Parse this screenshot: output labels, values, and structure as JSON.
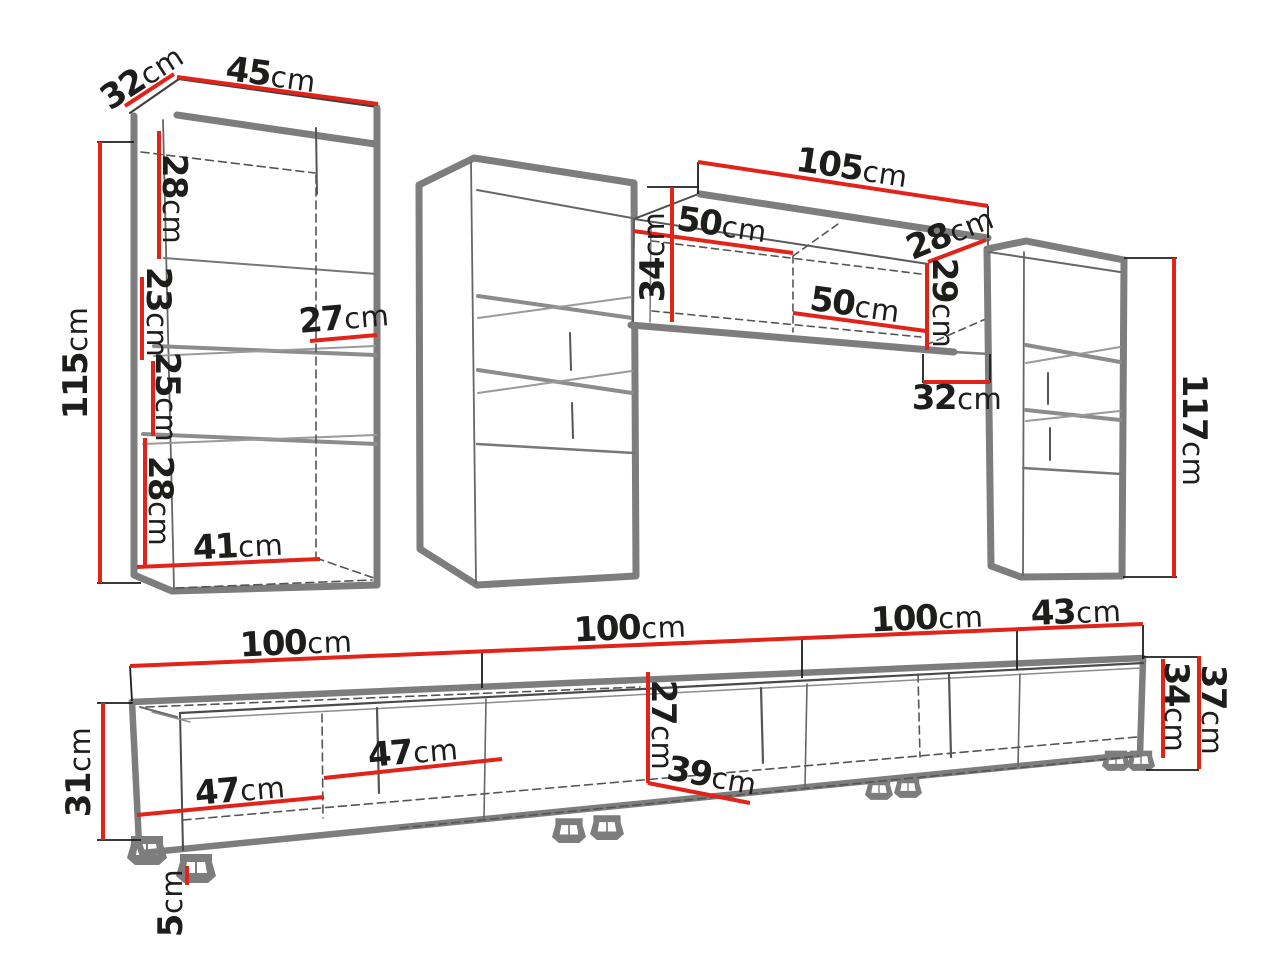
{
  "diagram": {
    "type": "furniture-wall-unit-dimension-diagram",
    "unit": "cm",
    "colors": {
      "dimension_red": "#e2231a",
      "outline_gray": "#7d7d7d",
      "detail_gray": "#4d4d4d",
      "text_black": "#1d1d1b",
      "background": "#ffffff"
    },
    "labels": {
      "left_cab_depth": {
        "num": "32",
        "unit": "cm"
      },
      "left_cab_width": {
        "num": "45",
        "unit": "cm"
      },
      "left_cab_height": {
        "num": "115",
        "unit": "cm"
      },
      "left_cab_sec1": {
        "num": "28",
        "unit": "cm"
      },
      "left_cab_sec2": {
        "num": "23",
        "unit": "cm"
      },
      "left_cab_sec3": {
        "num": "25",
        "unit": "cm"
      },
      "left_cab_sec4": {
        "num": "28",
        "unit": "cm"
      },
      "left_cab_shelf_depth": {
        "num": "27",
        "unit": "cm"
      },
      "left_cab_inner_width": {
        "num": "41",
        "unit": "cm"
      },
      "wall_cab_width": {
        "num": "105",
        "unit": "cm"
      },
      "wall_cab_half_left": {
        "num": "50",
        "unit": "cm"
      },
      "wall_cab_height": {
        "num": "34",
        "unit": "cm"
      },
      "wall_cab_depth": {
        "num": "28",
        "unit": "cm"
      },
      "wall_cab_right_height": {
        "num": "29",
        "unit": "cm"
      },
      "wall_cab_half_right": {
        "num": "50",
        "unit": "cm"
      },
      "wall_cab_offset": {
        "num": "32",
        "unit": "cm"
      },
      "right_cab_height": {
        "num": "117",
        "unit": "cm"
      },
      "tv_seg1": {
        "num": "100",
        "unit": "cm"
      },
      "tv_seg2": {
        "num": "100",
        "unit": "cm"
      },
      "tv_seg3": {
        "num": "100",
        "unit": "cm"
      },
      "tv_seg4": {
        "num": "43",
        "unit": "cm"
      },
      "tv_height": {
        "num": "31",
        "unit": "cm"
      },
      "tv_door1": {
        "num": "47",
        "unit": "cm"
      },
      "tv_door2": {
        "num": "47",
        "unit": "cm"
      },
      "tv_inner_height": {
        "num": "27",
        "unit": "cm"
      },
      "tv_inner_depth": {
        "num": "39",
        "unit": "cm"
      },
      "tv_right_inner_height": {
        "num": "34",
        "unit": "cm"
      },
      "tv_right_height": {
        "num": "37",
        "unit": "cm"
      },
      "tv_leg_height": {
        "num": "5",
        "unit": "cm"
      }
    }
  }
}
